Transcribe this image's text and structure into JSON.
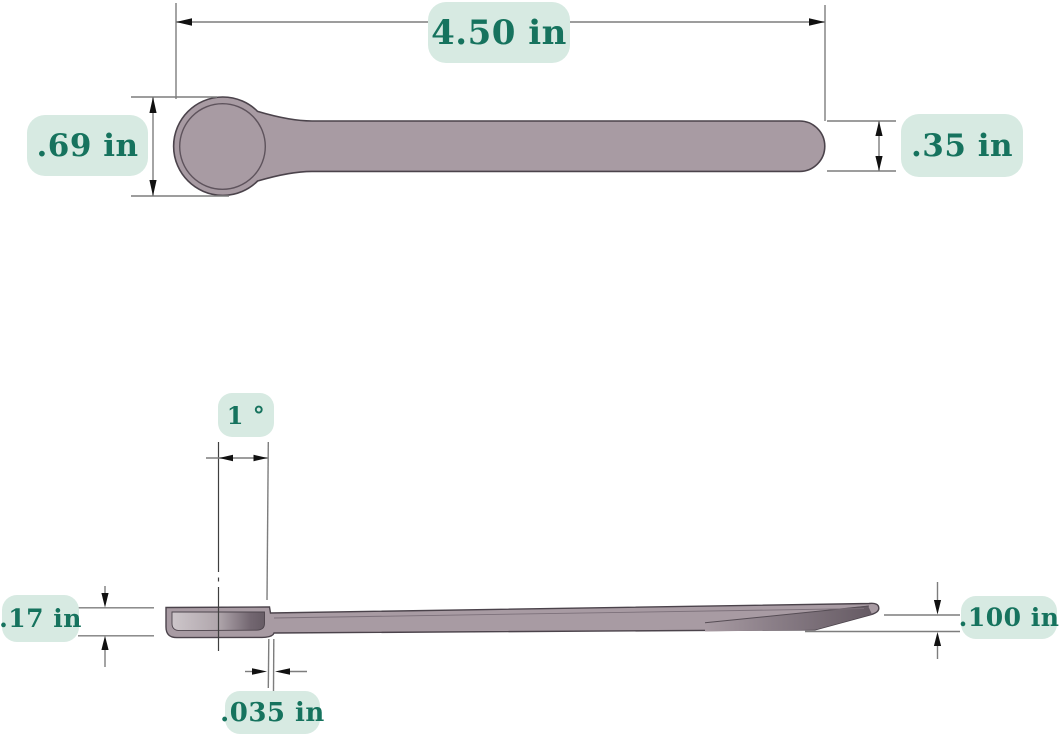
{
  "figure": {
    "kind": "dimensioned engineering drawing, two views of a scoop/spoon",
    "views": {
      "top_view": "plan view of scoop",
      "side_view": "profile view of scoop"
    }
  },
  "colors": {
    "badge_bg": "#d7eae2",
    "badge_text": "#16735e",
    "part_fill": "#a89ba3",
    "part_outline": "#4b434b",
    "dimension_line": "#7d7d7d",
    "centerline": "#3f3f3f",
    "arrow": "#111111"
  },
  "dimensions": {
    "overall_length": {
      "label": "4.50 in"
    },
    "scoop_diameter": {
      "label": ".69 in"
    },
    "handle_width": {
      "label": ".35 in"
    },
    "draft_angle": {
      "label": "1 °"
    },
    "scoop_depth": {
      "label": ".17 in"
    },
    "wall_thickness": {
      "label": ".035 in"
    },
    "tip_thickness": {
      "label": ".100 in"
    }
  }
}
